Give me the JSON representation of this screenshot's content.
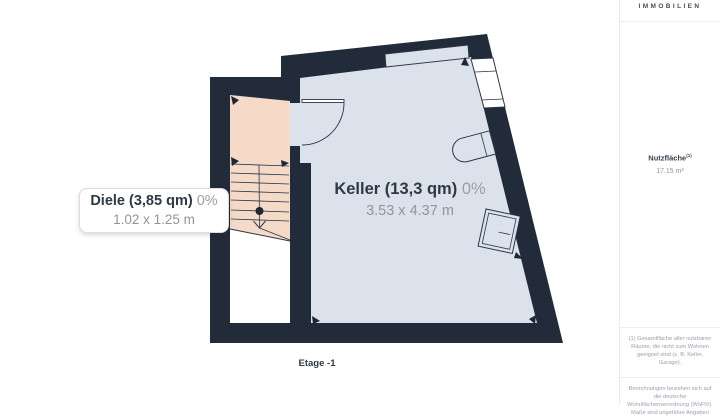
{
  "sidebar": {
    "brand": "IMMOBILIEN",
    "area_label": "Nutzfläche",
    "area_sup": "(1)",
    "area_value": "17.15 m²",
    "footnote_definition": "(1) Gesamtfläche aller nutzbaren Räume, die nicht zum Wohnen geeignet sind (z. B. Keller, Garage).",
    "footnote_calculation": "Berechnungen beziehen sich auf die deutsche Wohnflächenverordnung (WoFlV). Maße sind ungefähre Angaben"
  },
  "floorplan": {
    "floor_label": "Etage -1",
    "rooms": [
      {
        "name": "Keller",
        "label": "Keller (13,3 qm)",
        "percent": "0%",
        "dimensions": "3.53 x 4.37 m"
      },
      {
        "name": "Diele",
        "label": "Diele (3,85 qm)",
        "percent": "0%",
        "dimensions": "1.02 x 1.25 m"
      }
    ],
    "colors": {
      "wall": "#212b3a",
      "room_fill": "#dce2eb",
      "hall_fill": "#f5dbc7",
      "line": "#2a3648",
      "label_dark": "#2e3945",
      "label_gray": "#8d96a0"
    }
  }
}
